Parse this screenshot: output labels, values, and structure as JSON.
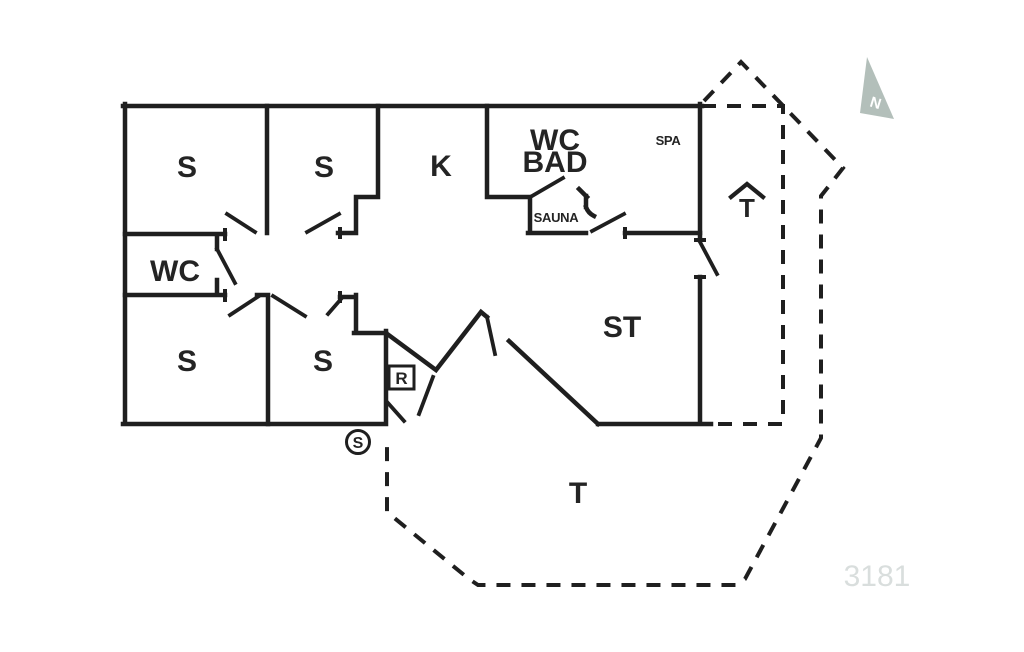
{
  "plan_number": "3181",
  "north_label": "N",
  "rooms": {
    "bedroom_nw": "S",
    "bedroom_n": "S",
    "kitchen": "K",
    "bath_line1": "WC",
    "bath_line2": "BAD",
    "spa": "SPA",
    "sauna": "SAUNA",
    "wc": "WC",
    "bedroom_sw": "S",
    "bedroom_s": "S",
    "living_room": "ST",
    "terrace": "T",
    "covered_terrace": "T",
    "utility": "R",
    "cupboard": "S"
  },
  "colors": {
    "wall": "#1f1f1f",
    "background": "#ffffff",
    "plan_number_text": "#d9dedd",
    "north_arrow_fill": "#b3bfba"
  }
}
